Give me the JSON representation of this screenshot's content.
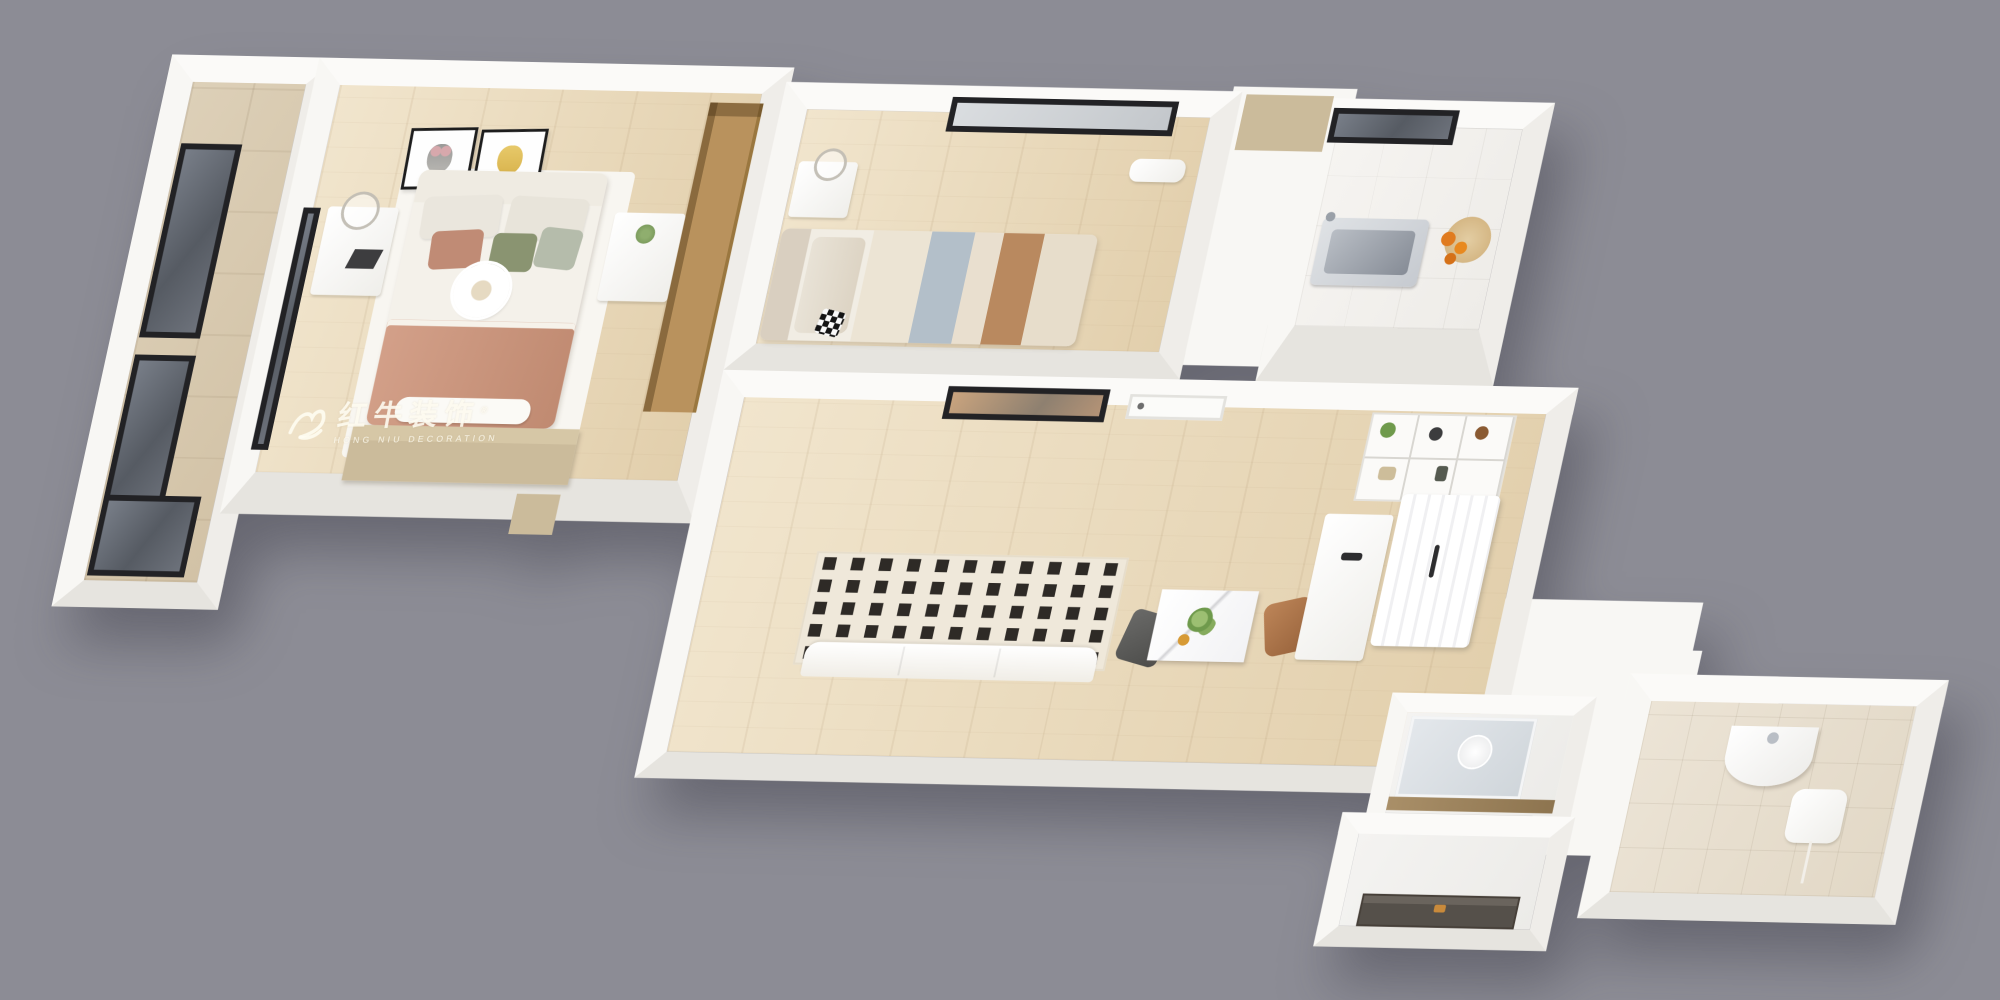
{
  "scene": {
    "description": "3D isometric top-down rendering of a small apartment floor plan on a plain gray backdrop",
    "background_color": "#8C8C95",
    "wall_color": "#F8F7F4"
  },
  "watermark": {
    "logo": "bull-icon",
    "registered_mark": "®",
    "title": "红牛装饰",
    "subtitle": "HONG NIU DECORATION",
    "color": "#FFFDF2"
  },
  "palette": {
    "wood_floor": "#ECDCC1",
    "balcony_tile": "#D8C9AF",
    "kitchen_tile": "#F3F1EE",
    "bathroom_tile": "#E8E0D2",
    "window_frame": "#222225",
    "window_glass": "#6B7078",
    "wardrobe_wood": "#B9925D",
    "dresser_tan": "#CBBB9B",
    "blanket_pink": "#C9947C",
    "media_panel_cream": "#EFE8DA",
    "media_panel_square": "#2E2A26",
    "chair_brown": "#A9744B",
    "chair_gray": "#5A5A58",
    "fruit_orange": "#E07B1F",
    "entry_door": "#55504A",
    "door_handle": "#C98A3B"
  },
  "rooms": [
    {
      "name": "balcony",
      "floor": "beige tile",
      "features": [
        "full-height black-frame window wall",
        "lower exterior window"
      ]
    },
    {
      "name": "master-bedroom",
      "floor": "light wood",
      "features": [
        "two animal art prints (koala and yellow bear)",
        "double bed with pink blanket and flower pillow",
        "left nightstand with ring lamp and books",
        "right nightstand with plant",
        "tan dresser bench at bed foot",
        "tall wood wardrobe",
        "interior window to balcony",
        "white rug",
        "wall vent square"
      ]
    },
    {
      "name": "second-bedroom",
      "floor": "light wood",
      "features": [
        "black-frame window with white blind",
        "wall air-conditioner",
        "bedside desk with lamp",
        "bed with beige, blue-gray and brown striped bedding",
        "black-white checkered pillow"
      ]
    },
    {
      "name": "kitchen",
      "floor": "white tile",
      "features": [
        "black-frame window",
        "stainless-steel sink",
        "cutting board with oranges",
        "white cabinetry"
      ]
    },
    {
      "name": "living-dining-room",
      "floor": "light wood",
      "features": [
        "window with warm reflection",
        "white interior door",
        "cream media wall with grid of dark squares",
        "white sofa",
        "dark gray accent chair",
        "white marble dining table with green plant",
        "brown leather dining chair",
        "open decor shelving",
        "white refrigerator",
        "white sideboard cabinet"
      ]
    },
    {
      "name": "shower-room",
      "features": [
        "glass partition",
        "round mirror",
        "wood threshold"
      ]
    },
    {
      "name": "entry-hall",
      "features": [
        "dark entrance door with brass handle"
      ]
    },
    {
      "name": "bathroom",
      "floor": "beige tile",
      "features": [
        "corner wash basin",
        "wall-mounted water heater with cord"
      ]
    }
  ]
}
